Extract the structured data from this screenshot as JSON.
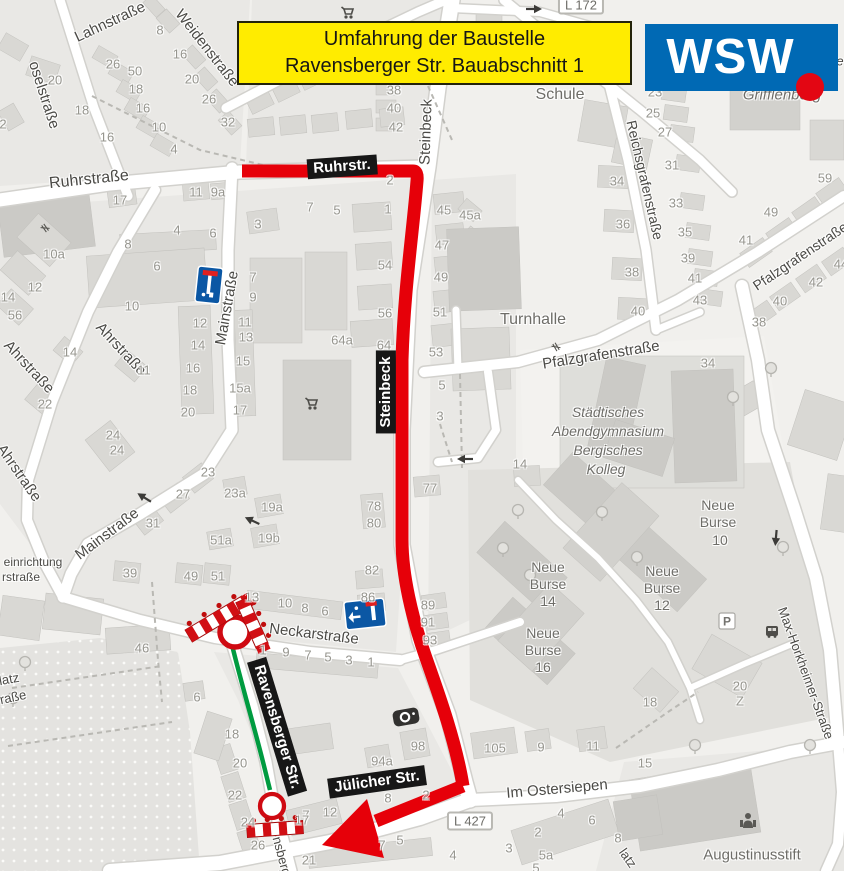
{
  "title_banner": {
    "line1": "Umfahrung der Baustelle",
    "line2": "Ravensberger Str. Bauabschnitt 1"
  },
  "logo": {
    "text": "WSW"
  },
  "colors": {
    "banner_bg": "#ffec00",
    "logo_bg": "#0069b4",
    "logo_dot": "#e30613",
    "route_red": "#e60009",
    "closure_green": "#009b40",
    "map_bg": "#f1f0ed"
  },
  "route_labels": [
    {
      "text": "Ruhrstr.",
      "x": 342,
      "y": 167,
      "rot": -4,
      "size": 15
    },
    {
      "text": "Steinbeck",
      "x": 386,
      "y": 392,
      "rot": -90,
      "size": 15
    },
    {
      "text": "Ravensberger Str.",
      "x": 277,
      "y": 727,
      "rot": 73,
      "size": 15
    },
    {
      "text": "Jülicher Str.",
      "x": 377,
      "y": 782,
      "rot": -8,
      "size": 15
    }
  ],
  "street_labels": [
    {
      "text": "oselstraße",
      "x": 44,
      "y": 95,
      "rot": 72,
      "size": 15
    },
    {
      "text": "Lahnstraße",
      "x": 110,
      "y": 22,
      "rot": -25,
      "size": 15
    },
    {
      "text": "Weidenstraße",
      "x": 207,
      "y": 48,
      "rot": 52,
      "size": 15
    },
    {
      "text": "Ruhrstraße",
      "x": 89,
      "y": 180,
      "rot": -6,
      "size": 16
    },
    {
      "text": "Steinbeck",
      "x": 426,
      "y": 132,
      "rot": -88,
      "size": 15
    },
    {
      "text": "Mainstraße",
      "x": 227,
      "y": 308,
      "rot": -80,
      "size": 15
    },
    {
      "text": "Mainstraße",
      "x": 107,
      "y": 534,
      "rot": -37,
      "size": 15
    },
    {
      "text": "Ahrstraße",
      "x": 29,
      "y": 367,
      "rot": 47,
      "size": 15
    },
    {
      "text": "Ahrstraße",
      "x": 121,
      "y": 349,
      "rot": 47,
      "size": 15
    },
    {
      "text": "Ahrstraße",
      "x": 19,
      "y": 473,
      "rot": 55,
      "size": 15
    },
    {
      "text": "Neckarstraße",
      "x": 314,
      "y": 634,
      "rot": 7,
      "size": 15
    },
    {
      "text": "Reichsgrafenstraße",
      "x": 645,
      "y": 180,
      "rot": 77,
      "size": 14
    },
    {
      "text": "Pfalzgrafenstraße",
      "x": 800,
      "y": 256,
      "rot": -34,
      "size": 14
    },
    {
      "text": "Pfalzgrafenstraße",
      "x": 601,
      "y": 355,
      "rot": -9,
      "size": 15
    },
    {
      "text": "Im Ostersiepen",
      "x": 557,
      "y": 789,
      "rot": -5,
      "size": 15
    },
    {
      "text": "Max-Horkheimer-Straße",
      "x": 806,
      "y": 673,
      "rot": 70,
      "size": 13
    },
    {
      "text": "nsberg",
      "x": 282,
      "y": 856,
      "rot": 75,
      "size": 13
    },
    {
      "text": "latz",
      "x": 9,
      "y": 679,
      "rot": -10,
      "size": 13
    },
    {
      "text": "raße",
      "x": 13,
      "y": 697,
      "rot": -12,
      "size": 13
    },
    {
      "text": "latz",
      "x": 628,
      "y": 858,
      "rot": 55,
      "size": 13
    },
    {
      "text": "einrichtung",
      "x": 33,
      "y": 562,
      "rot": 0,
      "size": 12
    },
    {
      "text": "rstraße",
      "x": 21,
      "y": 577,
      "rot": 0,
      "size": 12
    },
    {
      "text": "tätte",
      "x": 831,
      "y": 61,
      "rot": 0,
      "size": 13,
      "italic": true
    }
  ],
  "poi_labels": [
    {
      "text": "Schule",
      "x": 560,
      "y": 95,
      "size": 16
    },
    {
      "text": "Turnhalle",
      "x": 533,
      "y": 320,
      "size": 16
    },
    {
      "text": "Städtisches",
      "x": 608,
      "y": 412,
      "size": 14,
      "italic": true
    },
    {
      "text": "Abendgymnasium",
      "x": 608,
      "y": 431,
      "size": 14,
      "italic": true
    },
    {
      "text": "Bergisches",
      "x": 608,
      "y": 450,
      "size": 14,
      "italic": true
    },
    {
      "text": "Kolleg",
      "x": 606,
      "y": 469,
      "size": 14,
      "italic": true
    },
    {
      "text": "Grifflenberg",
      "x": 782,
      "y": 95,
      "size": 15,
      "italic": true
    },
    {
      "text": "Neue",
      "x": 718,
      "y": 505,
      "size": 14
    },
    {
      "text": "Burse",
      "x": 718,
      "y": 522,
      "size": 14
    },
    {
      "text": "10",
      "x": 720,
      "y": 540,
      "size": 14
    },
    {
      "text": "Neue",
      "x": 662,
      "y": 571,
      "size": 14
    },
    {
      "text": "Burse",
      "x": 662,
      "y": 588,
      "size": 14
    },
    {
      "text": "12",
      "x": 662,
      "y": 605,
      "size": 14
    },
    {
      "text": "Neue",
      "x": 548,
      "y": 567,
      "size": 14
    },
    {
      "text": "Burse",
      "x": 548,
      "y": 584,
      "size": 14
    },
    {
      "text": "14",
      "x": 548,
      "y": 601,
      "size": 14
    },
    {
      "text": "Neue",
      "x": 543,
      "y": 633,
      "size": 14
    },
    {
      "text": "Burse",
      "x": 543,
      "y": 650,
      "size": 14
    },
    {
      "text": "16",
      "x": 543,
      "y": 667,
      "size": 14
    },
    {
      "text": "Augustinusstift",
      "x": 752,
      "y": 855,
      "size": 15
    }
  ],
  "road_refs": [
    {
      "text": "L 427",
      "x": 470,
      "y": 821
    },
    {
      "text": "L 172",
      "x": 581,
      "y": 5
    }
  ],
  "map_markers": [
    {
      "name": "no-entry-sign",
      "x": 235,
      "y": 632,
      "r": 15
    },
    {
      "name": "no-entry-sign",
      "x": 272,
      "y": 806,
      "r": 12
    },
    {
      "name": "construction-barrier",
      "x": 217,
      "y": 619,
      "len": 66,
      "h": 14,
      "rot": -31
    },
    {
      "name": "construction-barrier",
      "x": 252,
      "y": 623,
      "len": 50,
      "h": 13,
      "rot": 66
    },
    {
      "name": "construction-barrier",
      "x": 275,
      "y": 829,
      "len": 56,
      "h": 13,
      "rot": -4
    },
    {
      "name": "dead-end-sign",
      "x": 209,
      "y": 285,
      "w": 25,
      "h": 36,
      "rot": 6
    },
    {
      "name": "dead-end-sign",
      "x": 365,
      "y": 614,
      "w": 40,
      "h": 28,
      "rot": -6
    },
    {
      "name": "speed-camera-icon",
      "x": 406,
      "y": 717,
      "rot": -10
    },
    {
      "name": "parking-icon",
      "x": 727,
      "y": 621,
      "rot": 0
    },
    {
      "name": "bus-stop-icon",
      "x": 772,
      "y": 631,
      "rot": 0
    },
    {
      "name": "social-facility-icon",
      "x": 748,
      "y": 821,
      "rot": 0
    },
    {
      "name": "shopping-cart-icon",
      "x": 350,
      "y": 13,
      "rot": 0
    },
    {
      "name": "shopping-cart-icon",
      "x": 314,
      "y": 404,
      "rot": 0
    },
    {
      "name": "oneway-arrow-icon",
      "x": 253,
      "y": 521,
      "rot": 205
    },
    {
      "name": "oneway-arrow-icon",
      "x": 145,
      "y": 498,
      "rot": 212
    },
    {
      "name": "oneway-arrow-icon",
      "x": 466,
      "y": 459,
      "rot": 180
    },
    {
      "name": "oneway-arrow-icon",
      "x": 776,
      "y": 537,
      "rot": 95
    },
    {
      "name": "oneway-arrow-icon",
      "x": 533,
      "y": 9,
      "rot": 0
    },
    {
      "name": "gate-icon",
      "x": 45,
      "y": 228,
      "rot": 55
    },
    {
      "name": "gate-icon",
      "x": 556,
      "y": 347,
      "rot": 60
    },
    {
      "name": "tree-icon",
      "x": 771,
      "y": 368
    },
    {
      "name": "tree-icon",
      "x": 733,
      "y": 397
    },
    {
      "name": "tree-icon",
      "x": 518,
      "y": 510
    },
    {
      "name": "tree-icon",
      "x": 503,
      "y": 548
    },
    {
      "name": "tree-icon",
      "x": 602,
      "y": 512
    },
    {
      "name": "tree-icon",
      "x": 783,
      "y": 547
    },
    {
      "name": "tree-icon",
      "x": 695,
      "y": 745
    },
    {
      "name": "tree-icon",
      "x": 810,
      "y": 745
    },
    {
      "name": "tree-icon",
      "x": 25,
      "y": 662
    },
    {
      "name": "tree-icon",
      "x": 13,
      "y": 698
    },
    {
      "name": "tree-icon",
      "x": 637,
      "y": 557
    },
    {
      "name": "tree-icon",
      "x": 530,
      "y": 575
    }
  ],
  "house_numbers": [
    [
      "8",
      160,
      30
    ],
    [
      "26",
      113,
      64
    ],
    [
      "50",
      135,
      71
    ],
    [
      "16",
      180,
      54
    ],
    [
      "20",
      55,
      80
    ],
    [
      "20",
      192,
      79
    ],
    [
      "18",
      82,
      110
    ],
    [
      "18",
      136,
      89
    ],
    [
      "16",
      143,
      108
    ],
    [
      "26",
      209,
      99
    ],
    [
      "32",
      228,
      122
    ],
    [
      "16",
      107,
      137
    ],
    [
      "10",
      159,
      127
    ],
    [
      "4",
      174,
      149
    ],
    [
      "2",
      3,
      124
    ],
    [
      "11",
      196,
      192
    ],
    [
      "9a",
      218,
      192
    ],
    [
      "17",
      120,
      200
    ],
    [
      "38",
      394,
      90
    ],
    [
      "40",
      394,
      108
    ],
    [
      "42",
      396,
      127
    ],
    [
      "4",
      177,
      230
    ],
    [
      "6",
      213,
      233
    ],
    [
      "8",
      128,
      244
    ],
    [
      "6",
      157,
      266
    ],
    [
      "3",
      258,
      224
    ],
    [
      "10a",
      54,
      254
    ],
    [
      "12",
      35,
      287
    ],
    [
      "56",
      15,
      315
    ],
    [
      "10",
      132,
      306
    ],
    [
      "14",
      70,
      352
    ],
    [
      "11",
      144,
      370
    ],
    [
      "7",
      253,
      277
    ],
    [
      "9",
      253,
      297
    ],
    [
      "11",
      245,
      322
    ],
    [
      "13",
      246,
      337
    ],
    [
      "15",
      243,
      361
    ],
    [
      "15a",
      240,
      388
    ],
    [
      "17",
      240,
      410
    ],
    [
      "12",
      200,
      323
    ],
    [
      "14",
      198,
      345
    ],
    [
      "16",
      193,
      368
    ],
    [
      "18",
      190,
      390
    ],
    [
      "20",
      188,
      412
    ],
    [
      "22",
      45,
      404
    ],
    [
      "24",
      113,
      435
    ],
    [
      "24",
      117,
      450
    ],
    [
      "14",
      8,
      297
    ],
    [
      "2",
      390,
      180
    ],
    [
      "7",
      310,
      207
    ],
    [
      "5",
      337,
      210
    ],
    [
      "1",
      388,
      209
    ],
    [
      "45",
      444,
      210
    ],
    [
      "45a",
      470,
      215
    ],
    [
      "47",
      442,
      245
    ],
    [
      "49",
      441,
      277
    ],
    [
      "51",
      440,
      312
    ],
    [
      "54",
      385,
      265
    ],
    [
      "56",
      385,
      313
    ],
    [
      "64a",
      342,
      340
    ],
    [
      "64",
      384,
      345
    ],
    [
      "53",
      436,
      352
    ],
    [
      "5",
      442,
      385
    ],
    [
      "3",
      440,
      416
    ],
    [
      "77",
      430,
      488
    ],
    [
      "78",
      374,
      506
    ],
    [
      "80",
      374,
      523
    ],
    [
      "82",
      372,
      570
    ],
    [
      "86",
      368,
      597
    ],
    [
      "89",
      428,
      605
    ],
    [
      "91",
      428,
      622
    ],
    [
      "93",
      430,
      640
    ],
    [
      "13",
      252,
      597
    ],
    [
      "10",
      285,
      603
    ],
    [
      "8",
      305,
      608
    ],
    [
      "6",
      325,
      611
    ],
    [
      "1",
      263,
      650
    ],
    [
      "9",
      286,
      652
    ],
    [
      "7",
      308,
      655
    ],
    [
      "5",
      328,
      657
    ],
    [
      "3",
      349,
      660
    ],
    [
      "1",
      371,
      662
    ],
    [
      "6",
      197,
      697
    ],
    [
      "18",
      232,
      734
    ],
    [
      "23",
      208,
      472
    ],
    [
      "27",
      183,
      494
    ],
    [
      "31",
      153,
      523
    ],
    [
      "23a",
      235,
      493
    ],
    [
      "19a",
      272,
      507
    ],
    [
      "19b",
      269,
      538
    ],
    [
      "51a",
      221,
      540
    ],
    [
      "39",
      130,
      573
    ],
    [
      "49",
      191,
      576
    ],
    [
      "51",
      218,
      576
    ],
    [
      "46",
      142,
      648
    ],
    [
      "23",
      655,
      92
    ],
    [
      "25",
      653,
      113
    ],
    [
      "27",
      665,
      132
    ],
    [
      "31",
      672,
      165
    ],
    [
      "33",
      676,
      203
    ],
    [
      "35",
      685,
      232
    ],
    [
      "39",
      688,
      258
    ],
    [
      "41",
      695,
      278
    ],
    [
      "43",
      700,
      300
    ],
    [
      "34",
      617,
      181
    ],
    [
      "36",
      623,
      224
    ],
    [
      "38",
      632,
      272
    ],
    [
      "40",
      638,
      311
    ],
    [
      "59",
      825,
      178
    ],
    [
      "49",
      771,
      212
    ],
    [
      "41",
      746,
      240
    ],
    [
      "44",
      841,
      264
    ],
    [
      "42",
      816,
      282
    ],
    [
      "40",
      780,
      301
    ],
    [
      "38",
      759,
      322
    ],
    [
      "34",
      708,
      363
    ],
    [
      "14",
      520,
      464
    ],
    [
      "20",
      740,
      686
    ],
    [
      "Z",
      740,
      701
    ],
    [
      "18",
      650,
      702
    ],
    [
      "15",
      645,
      763
    ],
    [
      "98",
      418,
      746
    ],
    [
      "94a",
      382,
      761
    ],
    [
      "105",
      495,
      748
    ],
    [
      "9",
      541,
      747
    ],
    [
      "11",
      593,
      746
    ],
    [
      "12",
      330,
      812
    ],
    [
      "7",
      306,
      815
    ],
    [
      "5",
      400,
      840
    ],
    [
      "7",
      382,
      845
    ],
    [
      "4",
      453,
      855
    ],
    [
      "21",
      309,
      860
    ],
    [
      "3",
      509,
      848
    ],
    [
      "2",
      538,
      832
    ],
    [
      "4",
      561,
      813
    ],
    [
      "6",
      592,
      820
    ],
    [
      "5a",
      546,
      855
    ],
    [
      "5",
      536,
      868
    ],
    [
      "8",
      618,
      838
    ],
    [
      "20",
      240,
      763
    ],
    [
      "22",
      235,
      795
    ],
    [
      "24",
      248,
      822
    ],
    [
      "26",
      258,
      845
    ],
    [
      "17",
      302,
      820
    ],
    [
      "2",
      426,
      795
    ],
    [
      "8",
      388,
      798
    ]
  ]
}
